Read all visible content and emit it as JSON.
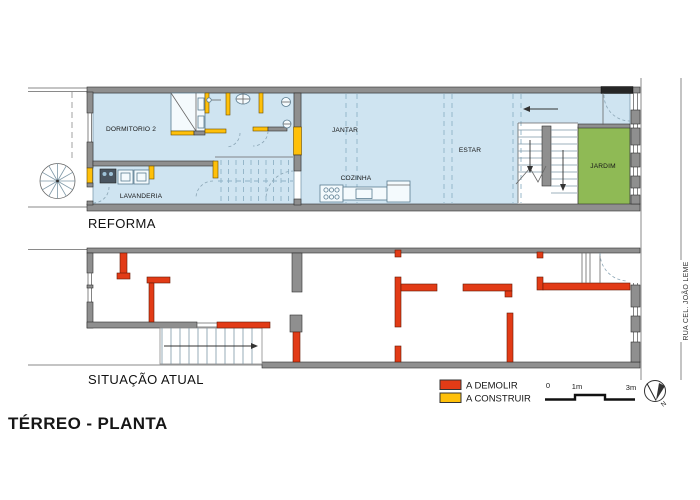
{
  "title": "TÉRREO - PLANTA",
  "reforma": {
    "label": "REFORMA",
    "rooms": {
      "dormitorio": "DORMITORIO 2",
      "lavanderia": "LAVANDERIA",
      "jantar": "JANTAR",
      "cozinha": "COZINHA",
      "estar": "ESTAR",
      "jardim": "JARDIM"
    }
  },
  "situacao": {
    "label": "SITUAÇÃO ATUAL"
  },
  "legend": {
    "demolir": {
      "label": "A DEMOLIR",
      "color": "#e23b16"
    },
    "construir": {
      "label": "A CONSTRUIR",
      "color": "#ffc00a"
    }
  },
  "scale_bar": {
    "t0": "0",
    "t1": "1m",
    "t3": "3m"
  },
  "street": {
    "name": "RUA CEL. JOÃO LEME"
  },
  "north": {
    "label": "N"
  },
  "colors": {
    "existing_fill": "#cfe4f1",
    "garden": "#8fba55",
    "wall": "#8f8f8f",
    "demolish": "#e23b16",
    "build": "#ffc00a"
  }
}
